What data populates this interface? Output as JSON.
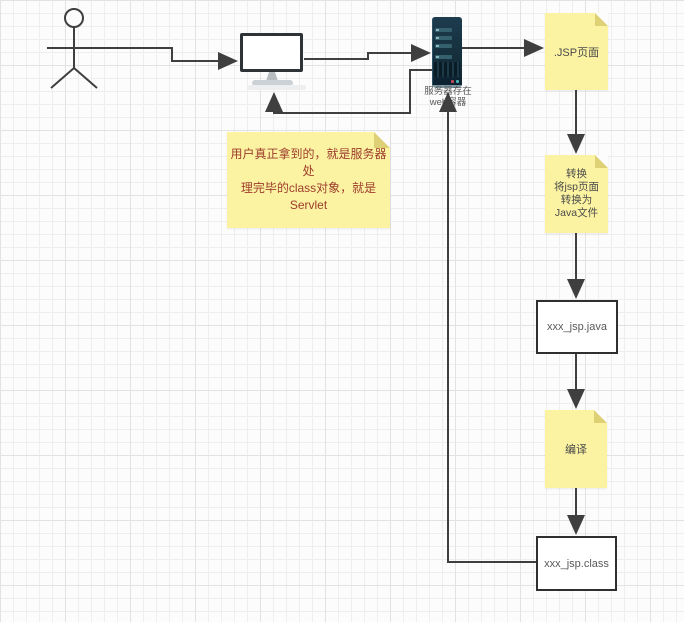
{
  "server": {
    "label_line1": "服务器存在",
    "label_line2": "web容器"
  },
  "notes": {
    "jsp": {
      "text": ".JSP页面"
    },
    "convert": {
      "lines": [
        "转换",
        "将jsp页面",
        "转换为",
        "Java文件"
      ]
    },
    "compile": {
      "text": "编译"
    },
    "servlet": {
      "lines": [
        "用户真正拿到的，就是服务器处",
        "理完毕的class对象，就是Servlet"
      ]
    }
  },
  "boxes": {
    "java_file": {
      "label": "xxx_jsp.java"
    },
    "class_file": {
      "label": "xxx_jsp.class"
    }
  },
  "colors": {
    "connector_line": "#3f3f3f",
    "note_background": "#fbf3a2",
    "note_fold": "#ddd075",
    "servlet_note_text": "#9d3c2c",
    "box_border": "#2f2f2f",
    "box_text": "#595959",
    "server_body": "#152f3d",
    "server_bar": "#35606d",
    "grid_line": "#eeeeee"
  }
}
